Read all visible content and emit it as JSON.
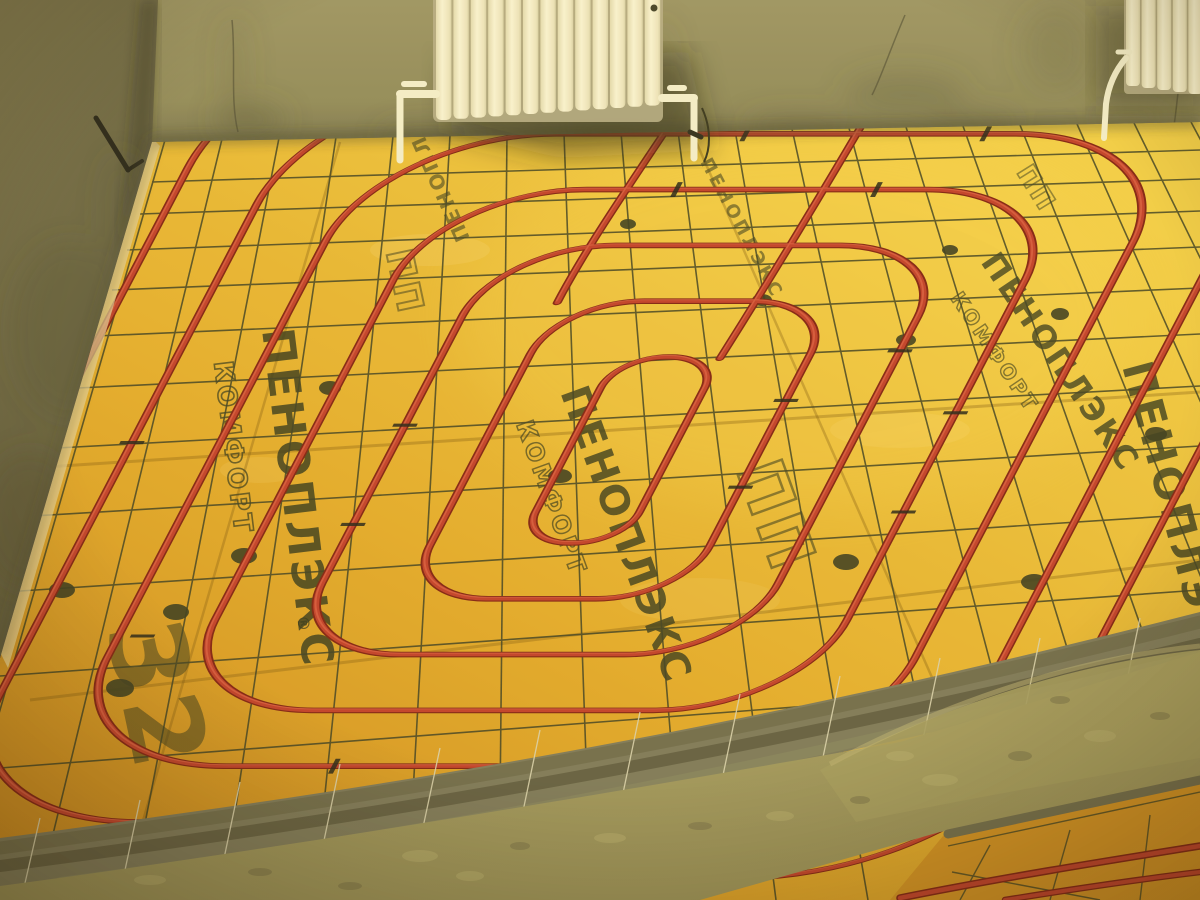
{
  "scene": {
    "kind": "photo of underfloor heating installation in unfinished room",
    "board_print": {
      "brand": "ПЕНОПЛЭКС",
      "product": "КОМФОРТ",
      "logo_glyph": "ПП",
      "thickness_mark": "32",
      "registered_mark": "®"
    },
    "radiator": {
      "sections_main": 13,
      "sections_corner": 5
    },
    "colors": {
      "wall_olive": "#8f8a5d",
      "wall_dark": "#6c684a",
      "left_wall": "#7c7751",
      "left_wall_dark": "#565339",
      "board_orange": "#c9861e",
      "board_amber": "#e2ab2c",
      "board_bright": "#f2cf48",
      "pipe_red": "#bf3d2b",
      "pipe_dark": "#7e2013",
      "pipe_highlight": "#e87050",
      "mesh_dark": "#3d4024",
      "mesh_bright": "#d8d2b0",
      "print_ink": "#2f351d",
      "radiator_white": "#f4efcf",
      "radiator_shade": "#b5ad88",
      "concrete": "#97905a",
      "gray_pipe": "#6e6b4e",
      "anchor_disc": "#383b20",
      "junction_seam": "#3c3c26"
    }
  }
}
